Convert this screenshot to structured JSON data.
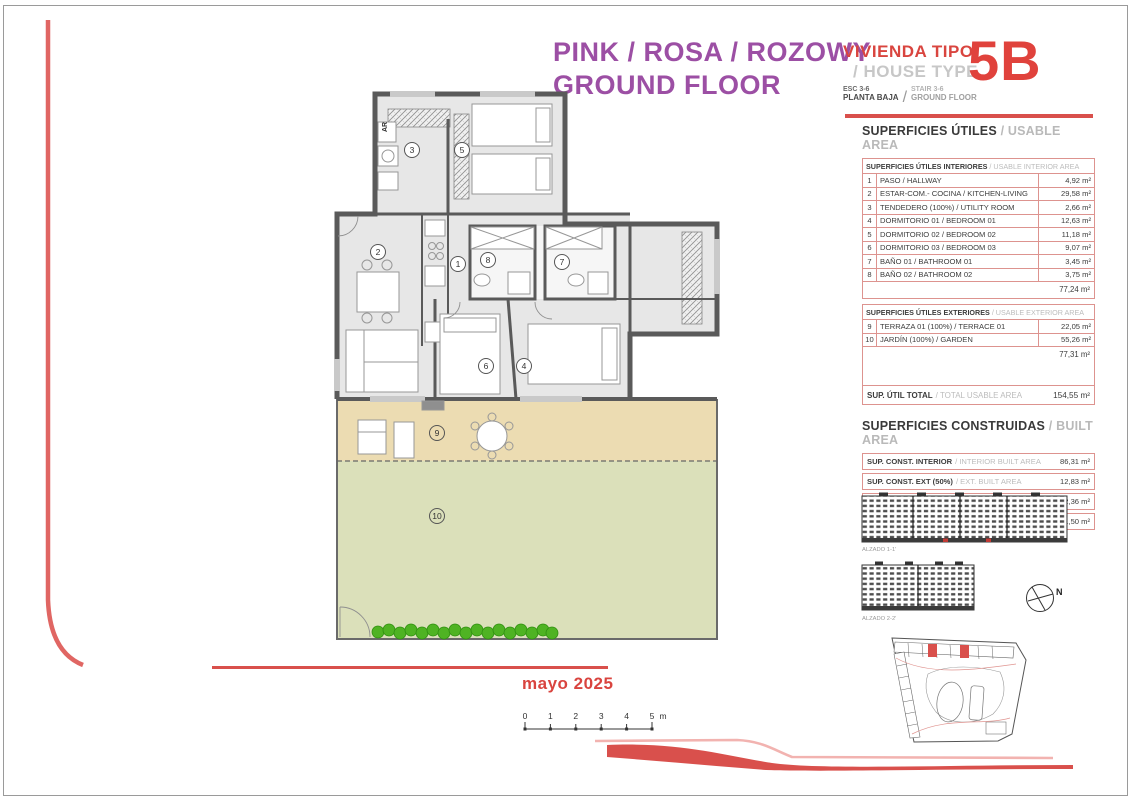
{
  "page": {
    "title_line1": "PINK / ROSA / ROZOWY",
    "title_line2": "GROUND FLOOR",
    "date": "mayo 2025"
  },
  "unit": {
    "type_es": "VIVIENDA TIPO",
    "type_en": "/ HOUSE TYPE",
    "code": "5B",
    "stair_es": "ESC 3-6",
    "floor_es": "PLANTA BAJA",
    "stair_en": "STAIR 3-6",
    "floor_en": "GROUND FLOOR"
  },
  "colors": {
    "accent_red": "#d9504c",
    "title_purple": "#9c4fa4",
    "table_border": "#dd938f",
    "terrace_fill": "#ecdcb2",
    "garden_fill": "#dbe0ba",
    "hedge_green": "#4fb323"
  },
  "usable": {
    "heading_es": "SUPERFICIES ÚTILES",
    "heading_en": "/ USABLE AREA",
    "interior": {
      "header_es": "SUPERFICIES ÚTILES INTERIORES",
      "header_en": "/ USABLE INTERIOR AREA",
      "rows": [
        {
          "num": "1",
          "label": "PASO / HALLWAY",
          "value": "4,92 m²"
        },
        {
          "num": "2",
          "label": "ESTAR-COM.- COCINA / KITCHEN-LIVING",
          "value": "29,58 m²"
        },
        {
          "num": "3",
          "label": "TENDEDERO (100%) / UTILITY ROOM",
          "value": "2,66 m²"
        },
        {
          "num": "4",
          "label": "DORMITORIO 01 / BEDROOM 01",
          "value": "12,63 m²"
        },
        {
          "num": "5",
          "label": "DORMITORIO 02 / BEDROOM 02",
          "value": "11,18 m²"
        },
        {
          "num": "6",
          "label": "DORMITORIO 03 / BEDROOM 03",
          "value": "9,07 m²"
        },
        {
          "num": "7",
          "label": "BAÑO 01 / BATHROOM 01",
          "value": "3,45 m²"
        },
        {
          "num": "8",
          "label": "BAÑO 02 / BATHROOM 02",
          "value": "3,75 m²"
        }
      ],
      "subtotal": "77,24 m²"
    },
    "exterior": {
      "header_es": "SUPERFICIES ÚTILES EXTERIORES",
      "header_en": "/ USABLE EXTERIOR AREA",
      "rows": [
        {
          "num": "9",
          "label": "TERRAZA 01 (100%) / TERRACE 01",
          "value": "22,05 m²"
        },
        {
          "num": "10",
          "label": "JARDÍN (100%) / GARDEN",
          "value": "55,26 m²"
        }
      ],
      "subtotal": "77,31 m²"
    },
    "total_es": "SUP. ÚTIL TOTAL",
    "total_en": "/ TOTAL USABLE AREA",
    "total_value": "154,55 m²"
  },
  "built": {
    "heading_es": "SUPERFICIES CONSTRUIDAS",
    "heading_en": "/ BUILT AREA",
    "rows": [
      {
        "label_es": "SUP. CONST. INTERIOR",
        "label_en": "/ INTERIOR BUILT AREA",
        "value": "86,31 m²"
      },
      {
        "label_es": "SUP. CONST. EXT (50%)",
        "label_en": "/ EXT. BUILT AREA",
        "value": "12,83 m²"
      },
      {
        "label_es": "SUP. CONST. Z/C",
        "label_en": "/ BUILT AREA SHARED AREAS",
        "value": "12,36 m²"
      },
      {
        "label_es": "SUP. CONS. TOTAL",
        "label_en": "/ TOTAL BUILT AREA",
        "value": "111,50 m²"
      }
    ]
  },
  "elevations": {
    "alzado1": "ALZADO 1-1'",
    "alzado2": "ALZADO 2-2'"
  },
  "compass": {
    "north": "N"
  },
  "plan": {
    "rooms": [
      "1",
      "2",
      "3",
      "4",
      "5",
      "6",
      "7",
      "8",
      "9",
      "10"
    ],
    "ar_label": "AR"
  },
  "scalebar": {
    "ticks": [
      "0",
      "1",
      "2",
      "3",
      "4",
      "5"
    ],
    "unit": "m"
  }
}
